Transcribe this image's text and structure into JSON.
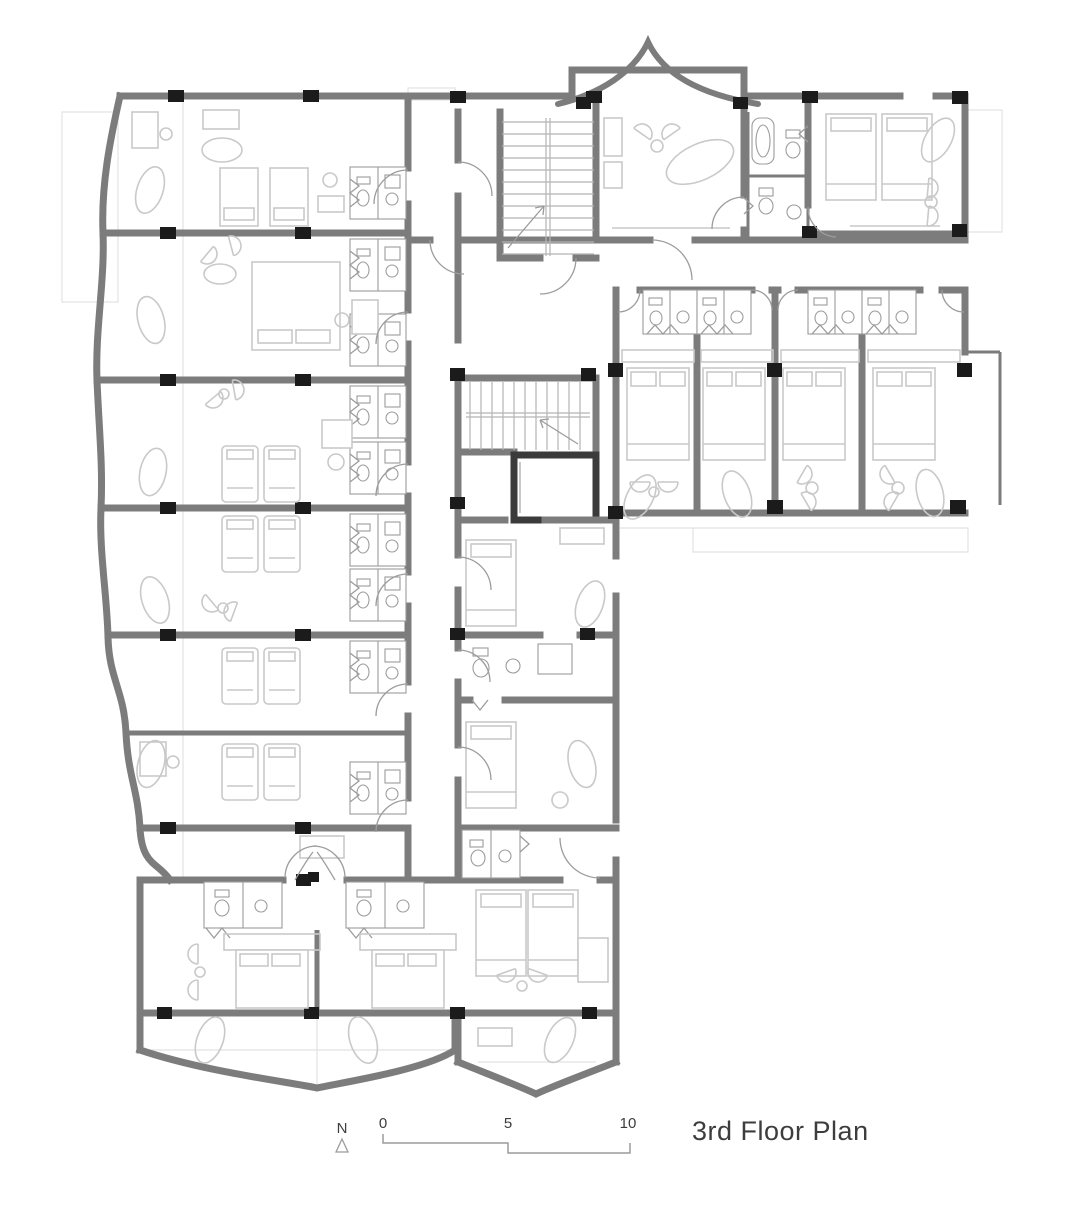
{
  "title": "3rd Floor Plan",
  "north": {
    "label": "N"
  },
  "scale_bar": {
    "tick_labels": [
      "0",
      "5",
      "10"
    ]
  },
  "colors": {
    "background": "#ffffff",
    "wall": "#7c7c7c",
    "column": "#1b1b1b",
    "elevator": "#3b3b3b",
    "furniture": "#c9c9c9",
    "thin_line": "#9c9c9c",
    "stair_line": "#b5b5b5",
    "faint": "#e2e2e2",
    "text": "#3d3d3d"
  }
}
